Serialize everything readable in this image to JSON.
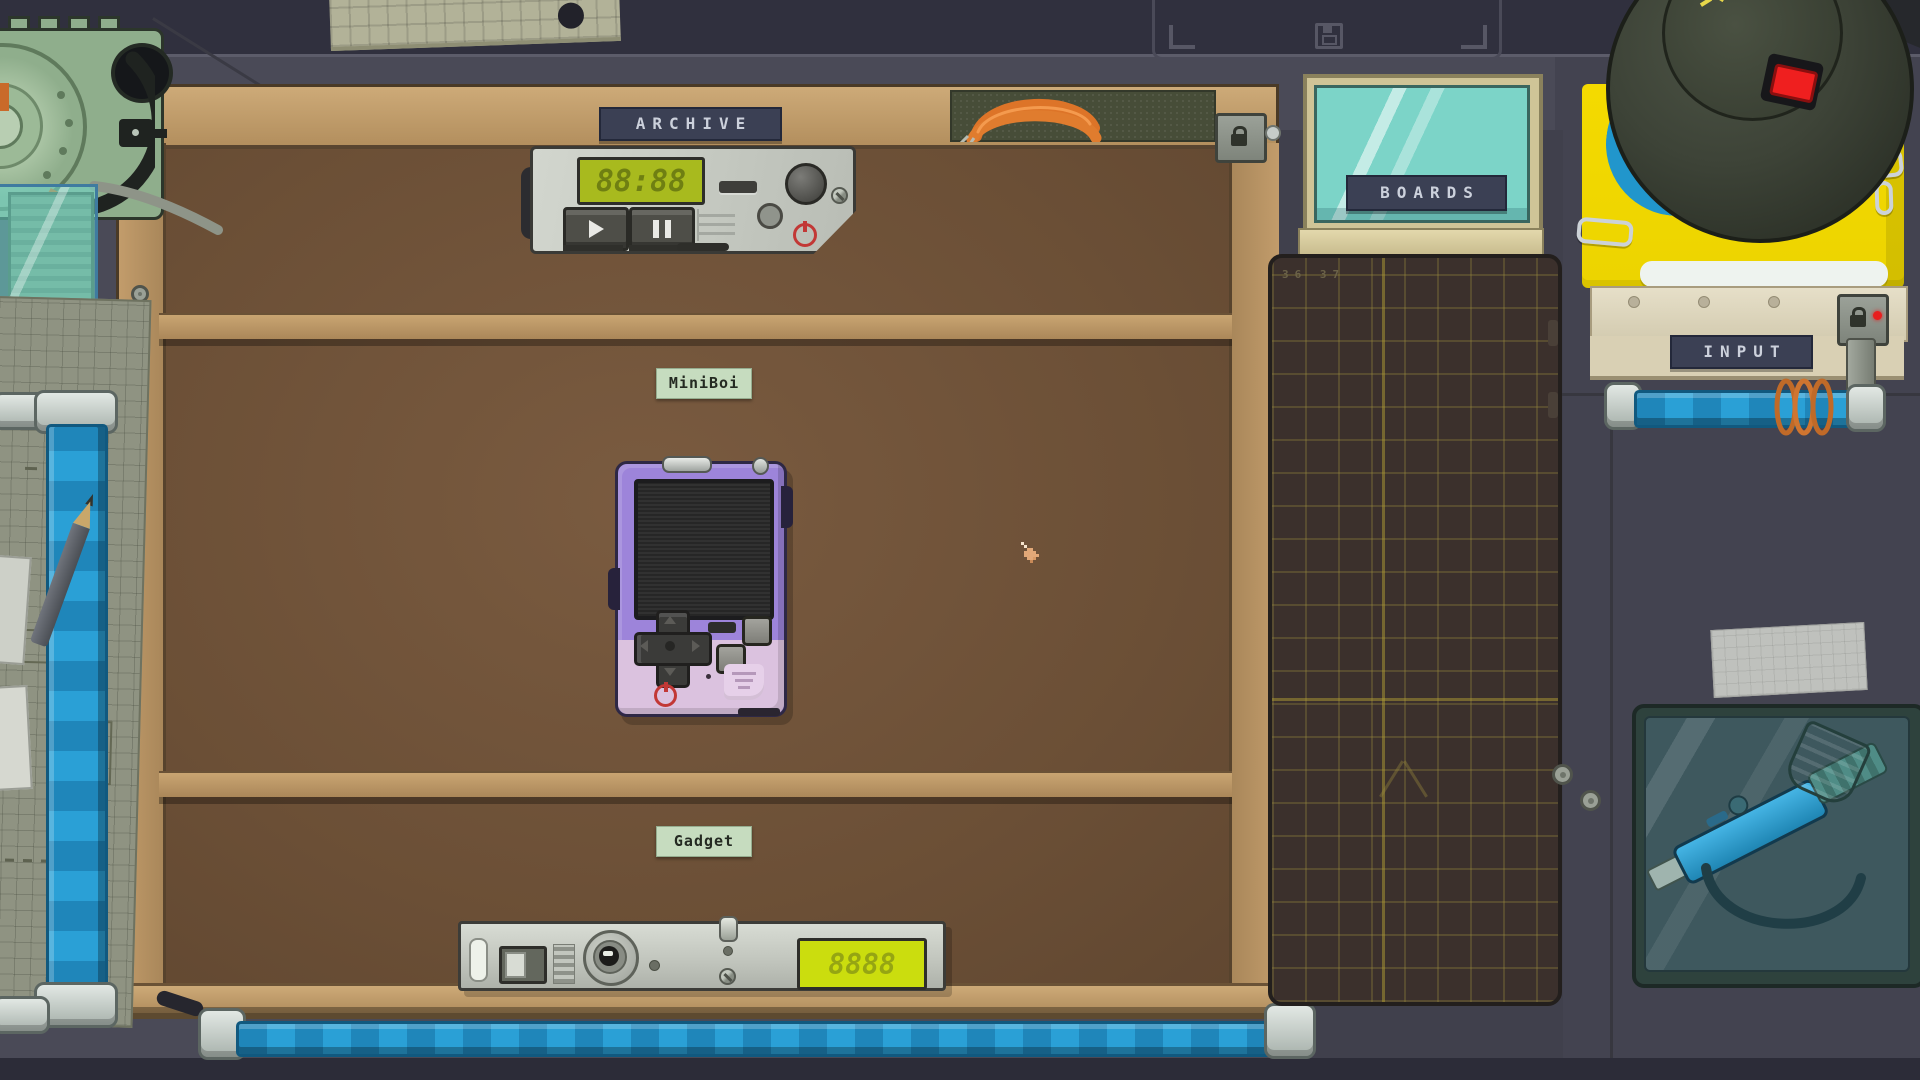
{
  "hud": {
    "save_slot_icon": "floppy-disk"
  },
  "desk": {
    "archive_label": "ARCHIVE",
    "miniboi_slot_label": "MiniBoi",
    "gadget_slot_label": "Gadget",
    "lock_icon": "padlock"
  },
  "devices": {
    "tape_player": {
      "lcd": "88:88",
      "play_icon": "play",
      "pause_icon": "pause",
      "power_icon": "power"
    },
    "miniboi": {
      "power_icon": "power",
      "dpad_icon": "d-pad",
      "speaker_icon": "speaker-grille"
    },
    "gadget": {
      "lcd": "8888"
    }
  },
  "right_panel": {
    "boards_label": "BOARDS",
    "input_label": "INPUT",
    "input_lock_icon": "padlock",
    "mat_ruler_numbers": "36 37"
  },
  "cursor": "pixel-hand-pointer",
  "colors": {
    "pipe_blue": "#2196cc",
    "lcd_green_bg": "#a8ba1e",
    "lcd_yellow_bg": "#cbdd0e",
    "pad_yellow": "#f2d800",
    "power_red": "#c23836",
    "lamp_switch_red": "#ef1f1f",
    "miniboi_purple": "#9d84da",
    "badge_navy": "#3b4054",
    "sticker_green": "#c6dcbf",
    "desk_wood": "#b3905e",
    "desk_interior": "#6f5339"
  }
}
